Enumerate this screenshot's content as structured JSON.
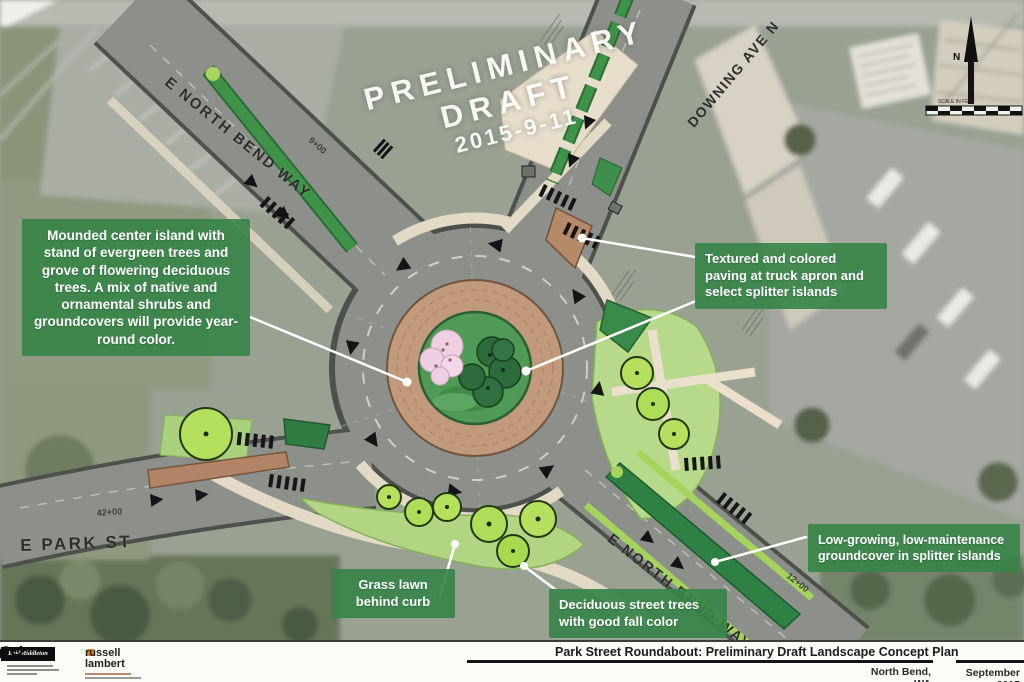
{
  "watermark": {
    "line1": "PRELIMINARY",
    "line2": "DRAFT",
    "date": "2015-9-11"
  },
  "streets": {
    "north_bend_nw": "E NORTH BEND WAY",
    "downing": "DOWNING AVE N",
    "park": "E PARK ST",
    "north_bend_se": "E NORTH BEND WAY"
  },
  "stations": [
    "9+00",
    "42+00",
    "12+00"
  ],
  "callouts": [
    {
      "id": "center-island",
      "text": "Mounded center island with stand of evergreen trees and grove of flowering deciduous trees. A mix of native and ornamental shrubs and groundcovers will provide year-round color."
    },
    {
      "id": "textured-paving",
      "text": "Textured and colored paving at truck apron and select splitter islands"
    },
    {
      "id": "groundcover",
      "text": "Low-growing, low-maintenance groundcover in splitter islands"
    },
    {
      "id": "grass-lawn",
      "text": "Grass lawn behind curb"
    },
    {
      "id": "street-trees",
      "text": "Deciduous street trees with good fall color"
    }
  ],
  "north_arrow": {
    "label": "N"
  },
  "scale_bar": {
    "label": "SCALE IN FEET"
  },
  "title_block": {
    "firm1": "ReidMiddleton",
    "firm2_line1": "russell",
    "firm2_line2": "lambert",
    "title": "Park Street Roundabout:  Preliminary Draft Landscape Concept Plan",
    "location": "North Bend, WA",
    "date": "September 2015"
  },
  "colors": {
    "road": "#8d908a",
    "road_outline": "#4e514b",
    "truck_apron": "#c19a7c",
    "center_island_green": "#4f9b55",
    "evergreen": "#2d6b3b",
    "flowering_pink": "#eecfe2",
    "lawn": "#b2d584",
    "street_tree": "#b5e05e",
    "median_green": "#2e8044",
    "splitter_tan": "#b58a69",
    "sidewalk": "#e6ddca",
    "callout_green": "#388449",
    "photo_base": "#99a193",
    "watermark_white": "#fdfdf8"
  }
}
